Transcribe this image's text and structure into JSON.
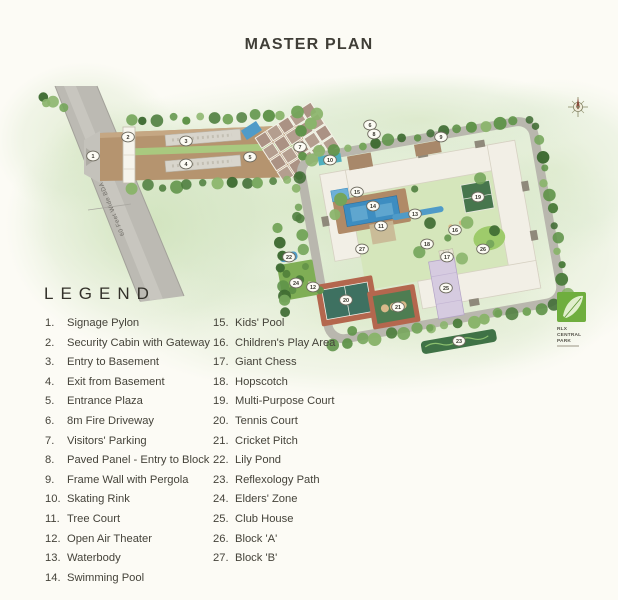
{
  "page": {
    "title": "MASTER PLAN"
  },
  "plan": {
    "road_label": "60 Feet Wide BDA Road",
    "logo": {
      "line1": "RLX",
      "line2": "CENTRAL",
      "line3": "PARK"
    },
    "colors": {
      "wash_green": "#d8e7c6",
      "road_gray": "#bcbab3",
      "driveway_tan": "#b5946f",
      "building_cream": "#f2efe6",
      "pool_blue": "#3d8dc1",
      "court_green": "#3e7161",
      "court_border": "#b4674e",
      "clubhouse_lavender": "#d6cbe0",
      "logo_green": "#6fae3e"
    },
    "markers": [
      {
        "n": "1",
        "x": 93,
        "y": 156
      },
      {
        "n": "2",
        "x": 128,
        "y": 137
      },
      {
        "n": "3",
        "x": 186,
        "y": 141
      },
      {
        "n": "4",
        "x": 186,
        "y": 164
      },
      {
        "n": "5",
        "x": 250,
        "y": 157
      },
      {
        "n": "6",
        "x": 370,
        "y": 125
      },
      {
        "n": "7",
        "x": 300,
        "y": 147
      },
      {
        "n": "8",
        "x": 374,
        "y": 134
      },
      {
        "n": "9",
        "x": 441,
        "y": 137
      },
      {
        "n": "10",
        "x": 330,
        "y": 160
      },
      {
        "n": "11",
        "x": 381,
        "y": 226
      },
      {
        "n": "12",
        "x": 313,
        "y": 287
      },
      {
        "n": "13",
        "x": 415,
        "y": 214
      },
      {
        "n": "14",
        "x": 373,
        "y": 206
      },
      {
        "n": "15",
        "x": 357,
        "y": 192
      },
      {
        "n": "16",
        "x": 455,
        "y": 230
      },
      {
        "n": "17",
        "x": 447,
        "y": 257
      },
      {
        "n": "18",
        "x": 427,
        "y": 244
      },
      {
        "n": "19",
        "x": 478,
        "y": 197
      },
      {
        "n": "20",
        "x": 346,
        "y": 300
      },
      {
        "n": "21",
        "x": 398,
        "y": 307
      },
      {
        "n": "22",
        "x": 289,
        "y": 257
      },
      {
        "n": "23",
        "x": 459,
        "y": 341
      },
      {
        "n": "24",
        "x": 296,
        "y": 283
      },
      {
        "n": "25",
        "x": 446,
        "y": 288
      },
      {
        "n": "26",
        "x": 483,
        "y": 249
      },
      {
        "n": "27",
        "x": 362,
        "y": 249
      }
    ]
  },
  "legend": {
    "title": "LEGEND",
    "columns": [
      [
        {
          "n": "1.",
          "label": "Signage Pylon"
        },
        {
          "n": "2.",
          "label": "Security Cabin with Gateway"
        },
        {
          "n": "3.",
          "label": "Entry to Basement"
        },
        {
          "n": "4.",
          "label": "Exit from Basement"
        },
        {
          "n": "5.",
          "label": "Entrance Plaza"
        },
        {
          "n": "6.",
          "label": "8m Fire Driveway"
        },
        {
          "n": "7.",
          "label": "Visitors' Parking"
        },
        {
          "n": "8.",
          "label": "Paved Panel - Entry to Block"
        },
        {
          "n": "9.",
          "label": "Frame Wall with Pergola"
        },
        {
          "n": "10.",
          "label": "Skating Rink"
        },
        {
          "n": "11.",
          "label": "Tree Court"
        },
        {
          "n": "12.",
          "label": "Open Air Theater"
        },
        {
          "n": "13.",
          "label": "Waterbody"
        },
        {
          "n": "14.",
          "label": "Swimming Pool"
        }
      ],
      [
        {
          "n": "15.",
          "label": "Kids' Pool"
        },
        {
          "n": "16.",
          "label": "Children's Play Area"
        },
        {
          "n": "17.",
          "label": "Giant Chess"
        },
        {
          "n": "18.",
          "label": "Hopscotch"
        },
        {
          "n": "19.",
          "label": "Multi-Purpose Court"
        },
        {
          "n": "20.",
          "label": "Tennis Court"
        },
        {
          "n": "21.",
          "label": "Cricket Pitch"
        },
        {
          "n": "22.",
          "label": "Lily Pond"
        },
        {
          "n": "23.",
          "label": "Reflexology Path"
        },
        {
          "n": "24.",
          "label": "Elders' Zone"
        },
        {
          "n": "25.",
          "label": "Club House"
        },
        {
          "n": "26.",
          "label": "Block 'A'"
        },
        {
          "n": "27.",
          "label": "Block 'B'"
        }
      ]
    ]
  }
}
